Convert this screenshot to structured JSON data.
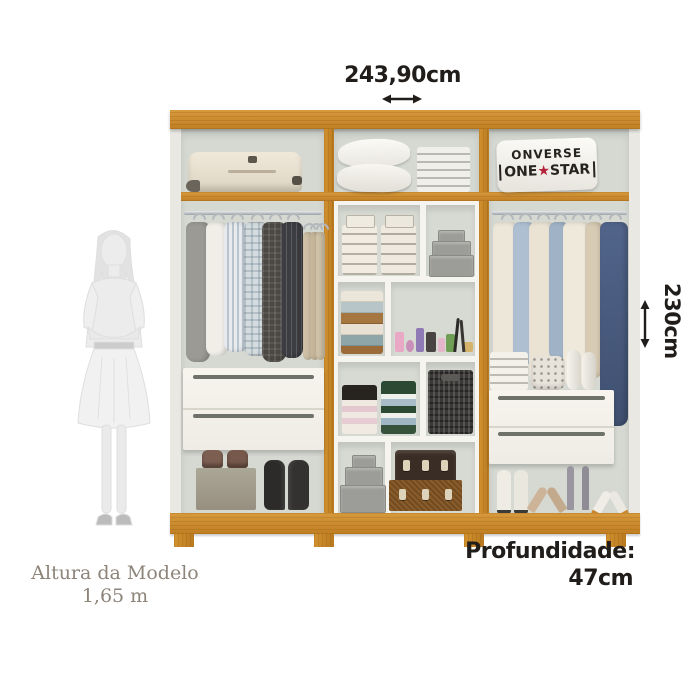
{
  "annotations": {
    "width": {
      "label": "243,90cm"
    },
    "height": {
      "label": "230cm"
    },
    "depth": {
      "title": "Profundidade:",
      "value": "47cm"
    },
    "model": {
      "line1": "Altura da Modelo",
      "line2": "1,65 m"
    }
  },
  "wardrobe": {
    "brand_bag": {
      "top": "ONVERSE",
      "bottom_left": "ONE",
      "star_icon": "★",
      "bottom_right": "STAR"
    },
    "columns": 3,
    "drawers_left": 2,
    "drawers_right": 2,
    "contents": {
      "left_top": "suitcase",
      "middle_top": "pillows and folded linens",
      "right_top": "branded sneaker bag",
      "left_hanging": "shirts, jackets and trousers on rod",
      "middle_shelves": "folded linens, gray boxes, towels, cosmetics, folded clothes, woven basket, storage trunks",
      "right_hanging": "coats, shirts and denim jacket on rod",
      "right_shelf": "folded linens, studded bag, rolled towels",
      "left_bottom": "shoe box, loafers, boots",
      "right_bottom": "four pairs of women's shoes"
    },
    "colors": {
      "wood": "#c9882f",
      "wood_dark": "#b97a20",
      "interior": "#d6d9d2",
      "shelf_white": "#f6f4ee",
      "drawer": "#f3f1ea",
      "star_red": "#b3233b",
      "denim": "#46597a",
      "silhouette": "#ececec"
    }
  }
}
